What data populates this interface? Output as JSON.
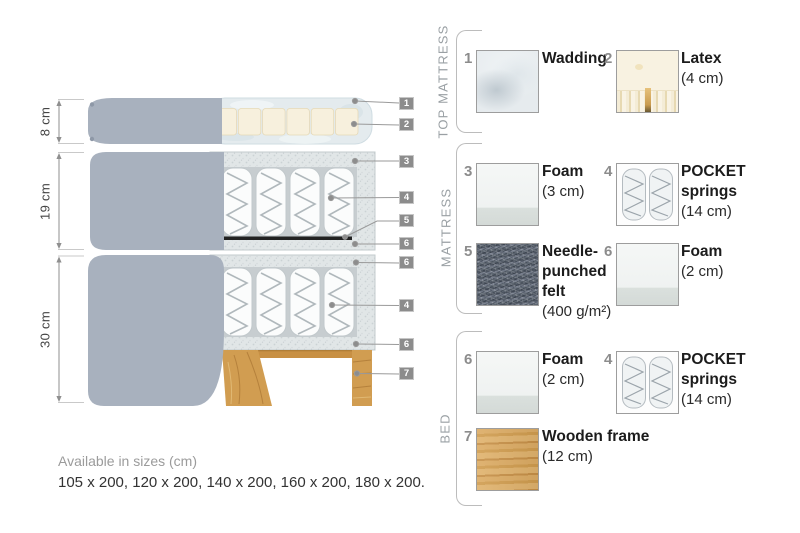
{
  "palette": {
    "fabric_gray": "#a8b1be",
    "foam_speckle": "#e1e6e7",
    "cavity_gray": "#c7cdd0",
    "spring_white": "#fbfcfc",
    "felt_line_black": "#222222",
    "wood_tan": "#d19d51",
    "latex_cream": "#f6efdc",
    "wadding_blue_white": "#e4ebee",
    "tag_gray": "#8c8c8c",
    "label_dark": "#1c1c1c",
    "section_label_gray": "#9aa0a4"
  },
  "diagram": {
    "dimensions": [
      "8 cm",
      "19 cm",
      "30 cm"
    ],
    "callouts": [
      "1",
      "2",
      "3",
      "4",
      "5",
      "6",
      "6",
      "4",
      "6",
      "7"
    ],
    "availability_title": "Available in sizes (cm)",
    "availability_sizes": "105 x 200, 120 x 200, 140 x 200, 160 x 200, 180 x 200."
  },
  "legend": {
    "sections": [
      {
        "label": "TOP MATTRESS"
      },
      {
        "label": "MATTRESS"
      },
      {
        "label": "BED"
      }
    ],
    "items": [
      {
        "num": "1",
        "lines": [
          "Wadding"
        ],
        "dim": ""
      },
      {
        "num": "2",
        "lines": [
          "Latex"
        ],
        "dim": "(4 cm)"
      },
      {
        "num": "3",
        "lines": [
          "Foam"
        ],
        "dim": "(3 cm)"
      },
      {
        "num": "4",
        "lines": [
          "POCKET",
          "springs"
        ],
        "dim": "(14 cm)"
      },
      {
        "num": "5",
        "lines": [
          "Needle-",
          "punched",
          "felt"
        ],
        "dim": "(400 g/m²)"
      },
      {
        "num": "6",
        "lines": [
          "Foam"
        ],
        "dim": "(2 cm)"
      },
      {
        "num": "6",
        "lines": [
          "Foam"
        ],
        "dim": "(2 cm)"
      },
      {
        "num": "4",
        "lines": [
          "POCKET",
          "springs"
        ],
        "dim": "(14 cm)"
      },
      {
        "num": "7",
        "lines": [
          "Wooden frame"
        ],
        "dim": "(12 cm)"
      }
    ]
  }
}
